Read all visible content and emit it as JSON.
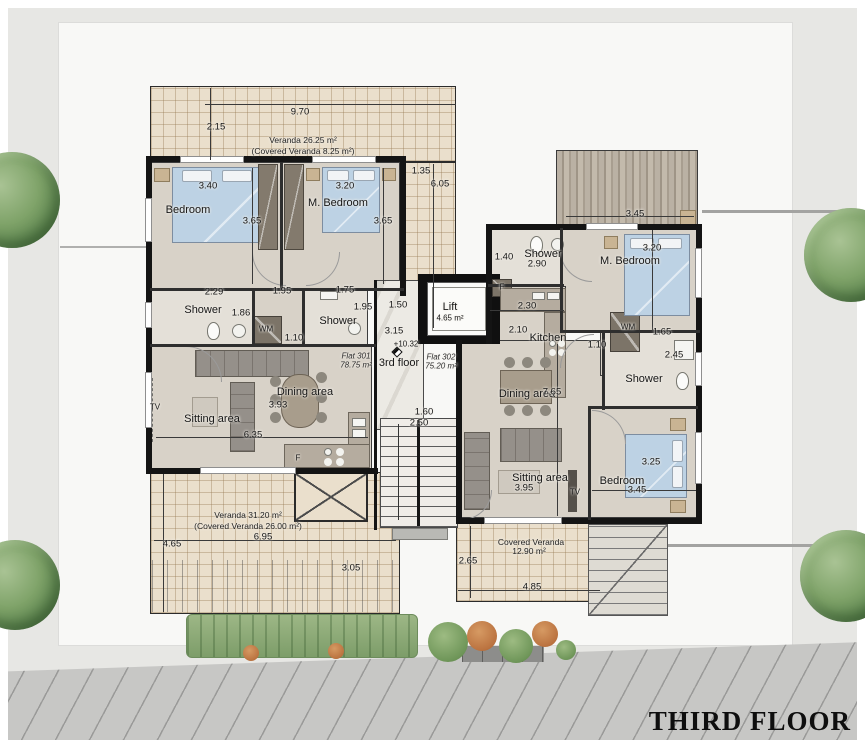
{
  "title": {
    "text": "THIRD FLOOR"
  },
  "colors": {
    "site_gray": "#e7e7e4",
    "pad_white": "#f8f8f6",
    "pavement": "#c7c7c5",
    "wall_black": "#141414",
    "floor_beige": "#d8d2c8",
    "tile_veranda": "#eadfcc",
    "bed_blue": "#bdd2e4",
    "tree_green": "#7fa369",
    "bush_orange": "#bb7340"
  },
  "annotations": [
    {
      "id": "dim-top-970",
      "text": "9.70",
      "x": 300,
      "y": 112,
      "kind": "dim"
    },
    {
      "id": "dim-top-215",
      "text": "2.15",
      "x": 216,
      "y": 127,
      "kind": "dim"
    },
    {
      "id": "veranda-north-label",
      "text": "Veranda 26.25 m²",
      "x": 303,
      "y": 140,
      "kind": "area"
    },
    {
      "id": "veranda-north-covered",
      "text": "(Covered Veranda 8.25 m²)",
      "x": 303,
      "y": 151,
      "kind": "area"
    },
    {
      "id": "dim-side-135",
      "text": "1.35",
      "x": 421,
      "y": 171,
      "kind": "dim"
    },
    {
      "id": "dim-side-605",
      "text": "6.05",
      "x": 440,
      "y": 184,
      "kind": "dim"
    },
    {
      "id": "dim-bed1-340",
      "text": "3.40",
      "x": 208,
      "y": 186,
      "kind": "dim"
    },
    {
      "id": "room-bedroom-1",
      "text": "Bedroom",
      "x": 188,
      "y": 210,
      "kind": "room"
    },
    {
      "id": "dim-bed1-365",
      "text": "3.65",
      "x": 252,
      "y": 221,
      "kind": "dim"
    },
    {
      "id": "dim-mbed1-320",
      "text": "3.20",
      "x": 345,
      "y": 186,
      "kind": "dim"
    },
    {
      "id": "room-mbedroom-1",
      "text": "M. Bedroom",
      "x": 338,
      "y": 203,
      "kind": "room"
    },
    {
      "id": "dim-mbed1-365",
      "text": "3.65",
      "x": 383,
      "y": 221,
      "kind": "dim"
    },
    {
      "id": "dim-cor-229",
      "text": "2.29",
      "x": 214,
      "y": 292,
      "kind": "dim"
    },
    {
      "id": "dim-cor-195",
      "text": "1.95",
      "x": 282,
      "y": 291,
      "kind": "dim"
    },
    {
      "id": "dim-cor-175",
      "text": "1.75",
      "x": 345,
      "y": 290,
      "kind": "dim"
    },
    {
      "id": "room-shower-1",
      "text": "Shower",
      "x": 203,
      "y": 310,
      "kind": "room"
    },
    {
      "id": "dim-shower1-186",
      "text": "1.86",
      "x": 241,
      "y": 313,
      "kind": "dim"
    },
    {
      "id": "label-wm-1",
      "text": "WM",
      "x": 266,
      "y": 329,
      "kind": "small"
    },
    {
      "id": "room-shower-2",
      "text": "Shower",
      "x": 338,
      "y": 321,
      "kind": "room"
    },
    {
      "id": "dim-shower2-195",
      "text": "1.95",
      "x": 363,
      "y": 307,
      "kind": "dim"
    },
    {
      "id": "dim-hall-110",
      "text": "1.10",
      "x": 294,
      "y": 338,
      "kind": "dim"
    },
    {
      "id": "label-tv-1",
      "text": "TV",
      "x": 155,
      "y": 407,
      "kind": "small"
    },
    {
      "id": "room-sitting-1",
      "text": "Sitting area",
      "x": 212,
      "y": 419,
      "kind": "room"
    },
    {
      "id": "room-dining-1",
      "text": "Dining area",
      "x": 305,
      "y": 392,
      "kind": "room"
    },
    {
      "id": "dim-dining1-393",
      "text": "3.93",
      "x": 278,
      "y": 405,
      "kind": "dim"
    },
    {
      "id": "dim-living1-635",
      "text": "6.35",
      "x": 253,
      "y": 435,
      "kind": "dim"
    },
    {
      "id": "label-fridge-1",
      "text": "F",
      "x": 298,
      "y": 458,
      "kind": "small"
    },
    {
      "id": "flat301-name",
      "text": "Flat 301",
      "x": 356,
      "y": 356,
      "kind": "flat"
    },
    {
      "id": "flat301-area",
      "text": "78.75 m²",
      "x": 356,
      "y": 365,
      "kind": "flat"
    },
    {
      "id": "floor-label",
      "text": "3rd floor",
      "x": 399,
      "y": 363,
      "kind": "room"
    },
    {
      "id": "level-mark",
      "text": "+10.32",
      "x": 406,
      "y": 344,
      "kind": "small"
    },
    {
      "id": "flat302-name",
      "text": "Flat 302",
      "x": 441,
      "y": 357,
      "kind": "flat"
    },
    {
      "id": "flat302-area",
      "text": "75.20 m²",
      "x": 441,
      "y": 366,
      "kind": "flat"
    },
    {
      "id": "dim-stair-150",
      "text": "1.50",
      "x": 398,
      "y": 305,
      "kind": "dim"
    },
    {
      "id": "dim-stair-315",
      "text": "3.15",
      "x": 394,
      "y": 331,
      "kind": "dim"
    },
    {
      "id": "lift-label",
      "text": "Lift",
      "x": 450,
      "y": 307,
      "kind": "room"
    },
    {
      "id": "lift-area",
      "text": "4.65 m²",
      "x": 450,
      "y": 318,
      "kind": "small"
    },
    {
      "id": "dim-stair-160",
      "text": "1.60",
      "x": 424,
      "y": 412,
      "kind": "dim"
    },
    {
      "id": "dim-stair-250",
      "text": "2.50",
      "x": 419,
      "y": 423,
      "kind": "dim"
    },
    {
      "id": "dim-sh302-140",
      "text": "1.40",
      "x": 504,
      "y": 257,
      "kind": "dim"
    },
    {
      "id": "room-shower-302a",
      "text": "Shower",
      "x": 543,
      "y": 254,
      "kind": "room"
    },
    {
      "id": "dim-sh302-290",
      "text": "2.90",
      "x": 537,
      "y": 264,
      "kind": "dim"
    },
    {
      "id": "label-fridge-2",
      "text": "F",
      "x": 502,
      "y": 287,
      "kind": "small"
    },
    {
      "id": "dim-kitchen-230",
      "text": "2.30",
      "x": 527,
      "y": 306,
      "kind": "dim"
    },
    {
      "id": "dim-kitchen-210",
      "text": "2.10",
      "x": 518,
      "y": 330,
      "kind": "dim"
    },
    {
      "id": "room-kitchen-302",
      "text": "Kitchen",
      "x": 548,
      "y": 338,
      "kind": "room"
    },
    {
      "id": "dim-wm2-110",
      "text": "1.10",
      "x": 597,
      "y": 345,
      "kind": "dim"
    },
    {
      "id": "label-wm-2",
      "text": "WM",
      "x": 628,
      "y": 327,
      "kind": "small"
    },
    {
      "id": "dim-wm2-165",
      "text": "1.65",
      "x": 662,
      "y": 332,
      "kind": "dim"
    },
    {
      "id": "dim-sh302b-245",
      "text": "2.45",
      "x": 674,
      "y": 355,
      "kind": "dim"
    },
    {
      "id": "room-shower-302b",
      "text": "Shower",
      "x": 644,
      "y": 379,
      "kind": "room"
    },
    {
      "id": "dim-mbed2-345",
      "text": "3.45",
      "x": 635,
      "y": 214,
      "kind": "dim"
    },
    {
      "id": "dim-mbed2-320",
      "text": "3.20",
      "x": 652,
      "y": 248,
      "kind": "dim"
    },
    {
      "id": "room-mbedroom-2",
      "text": "M. Bedroom",
      "x": 630,
      "y": 261,
      "kind": "room"
    },
    {
      "id": "room-dining-2",
      "text": "Dining area",
      "x": 527,
      "y": 394,
      "kind": "room"
    },
    {
      "id": "dim-living2-765",
      "text": "7.65",
      "x": 552,
      "y": 392,
      "kind": "dim"
    },
    {
      "id": "room-sitting-2",
      "text": "Sitting area",
      "x": 540,
      "y": 478,
      "kind": "room"
    },
    {
      "id": "dim-sitting2-395",
      "text": "3.95",
      "x": 524,
      "y": 488,
      "kind": "dim"
    },
    {
      "id": "label-tv-2",
      "text": "TV",
      "x": 575,
      "y": 492,
      "kind": "small"
    },
    {
      "id": "room-bedroom-3",
      "text": "Bedroom",
      "x": 622,
      "y": 481,
      "kind": "room"
    },
    {
      "id": "dim-bed3-345",
      "text": "3.45",
      "x": 637,
      "y": 490,
      "kind": "dim"
    },
    {
      "id": "dim-bed3-325",
      "text": "3.25",
      "x": 651,
      "y": 462,
      "kind": "dim"
    },
    {
      "id": "veranda-south-label",
      "text": "Veranda 31.20 m²",
      "x": 248,
      "y": 515,
      "kind": "area"
    },
    {
      "id": "veranda-south-covered",
      "text": "(Covered Veranda 26.00 m²)",
      "x": 248,
      "y": 526,
      "kind": "area"
    },
    {
      "id": "dim-vs-695",
      "text": "6.95",
      "x": 263,
      "y": 537,
      "kind": "dim"
    },
    {
      "id": "dim-vs-465",
      "text": "4.65",
      "x": 172,
      "y": 544,
      "kind": "dim"
    },
    {
      "id": "dim-vs-305",
      "text": "3.05",
      "x": 351,
      "y": 568,
      "kind": "dim"
    },
    {
      "id": "veranda-se-label",
      "text": "Covered Veranda",
      "x": 531,
      "y": 542,
      "kind": "area"
    },
    {
      "id": "veranda-se-area",
      "text": "12.90 m²",
      "x": 529,
      "y": 551,
      "kind": "area"
    },
    {
      "id": "dim-vse-265",
      "text": "2.65",
      "x": 468,
      "y": 561,
      "kind": "dim"
    },
    {
      "id": "dim-vse-485",
      "text": "4.85",
      "x": 532,
      "y": 587,
      "kind": "dim"
    }
  ]
}
